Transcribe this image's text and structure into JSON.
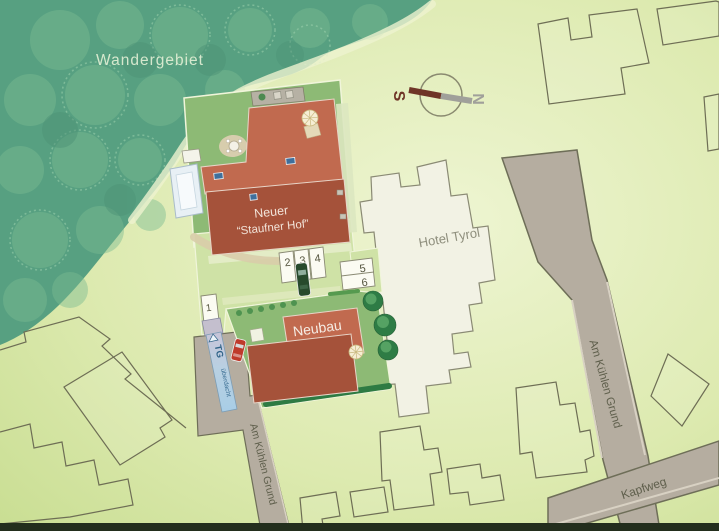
{
  "map": {
    "forest": {
      "label": "Wandergebiet"
    },
    "buildings": {
      "staufner_hof_line1": "Neuer",
      "staufner_hof_line2": "“Staufner Hof”",
      "hotel_tyrol": "Hotel Tyrol",
      "neubau": "Neubau"
    },
    "streets": {
      "left_street": "Am Kühlen Grund",
      "right_street": "Am Kühlen Grund",
      "bottom_street": "Kapfweg"
    },
    "parking": {
      "stall_1": "1",
      "stall_2": "2",
      "stall_3": "3",
      "stall_4": "4",
      "stall_5": "5",
      "stall_6": "6",
      "garage_abbr": "TG",
      "garage_note": "überdacht"
    },
    "compass": {
      "south": "S",
      "north": "N"
    },
    "colors": {
      "forest": "#579f80",
      "ground_light": "#ecf4c8",
      "ground_dark": "#c9de92",
      "plot_green": "#8dba75",
      "courtyard": "#cfe2a6",
      "building_light": "#c16a4f",
      "building_dark": "#a5523a",
      "hotel_fill": "#f2f2e4",
      "road_gray": "#b5ada0",
      "hedge_green": "#2e7b43",
      "ramp_blue": "#aed0e4",
      "compass_south": "#6f3527",
      "compass_north": "#a0a09a"
    }
  }
}
